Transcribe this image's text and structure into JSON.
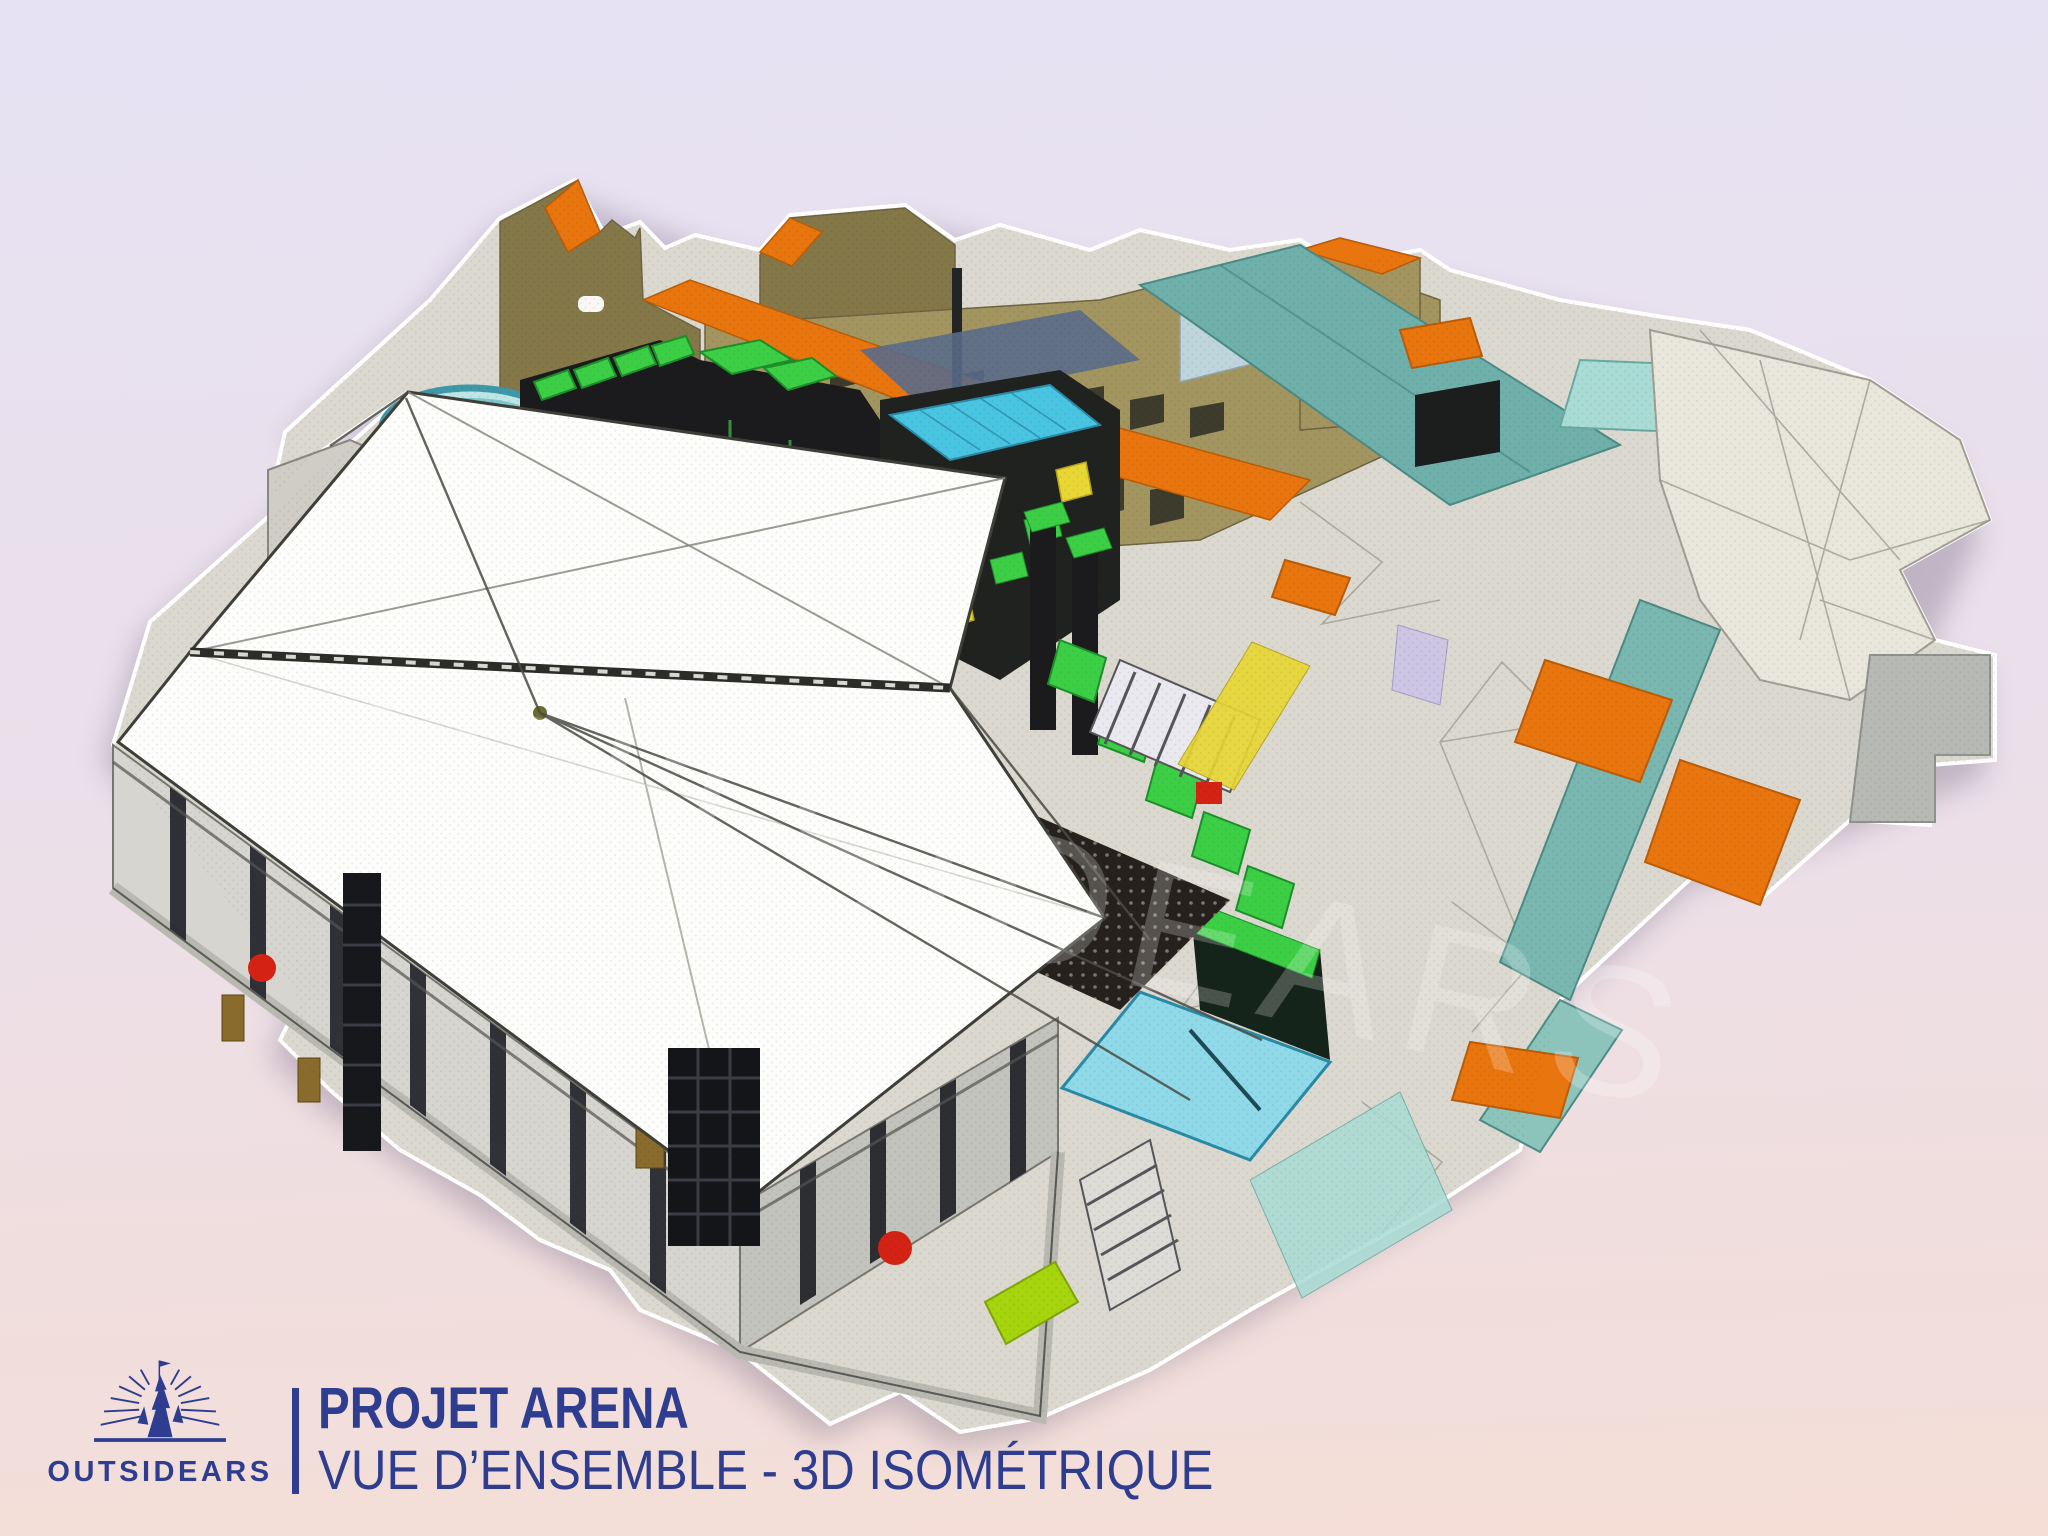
{
  "slide": {
    "watermark_text": "OUTSIDEARS"
  },
  "footer": {
    "logo": {
      "brand": "OUTSIDEARS",
      "icon": "castle-spire-with-rays-icon"
    },
    "title": "PROJET ARENA",
    "subtitle": "VUE D’ENSEMBLE - 3D ISOMÉTRIQUE"
  },
  "palette": {
    "navy": "#2e3d90",
    "bg_top": "#e6e2f4",
    "bg_bottom": "#f4ded6",
    "ground": "#dbd8d0",
    "ground_line": "#8f8c83",
    "wall_tan": "#a2955f",
    "wall_tan_dark": "#847748",
    "roof_orange": "#e8750e",
    "roof_orange_dark": "#bb5c08",
    "teal": "#6fb0ab",
    "teal_light": "#a8dcd4",
    "cyan": "#49c5e2",
    "green": "#3ccf46",
    "green_dark": "#1d8f2a",
    "truss_dark": "#1b1b1d",
    "canopy_white": "#fdfdfb",
    "canopy_line": "#3f3f3a",
    "wall_gray": "#d6d5cf",
    "wall_gray_dark": "#c3c3bd",
    "red": "#d42315",
    "lime": "#a6d40d",
    "yellow": "#e7d634",
    "shadow": "#7a6d86",
    "shell": "#e9e6dc"
  }
}
